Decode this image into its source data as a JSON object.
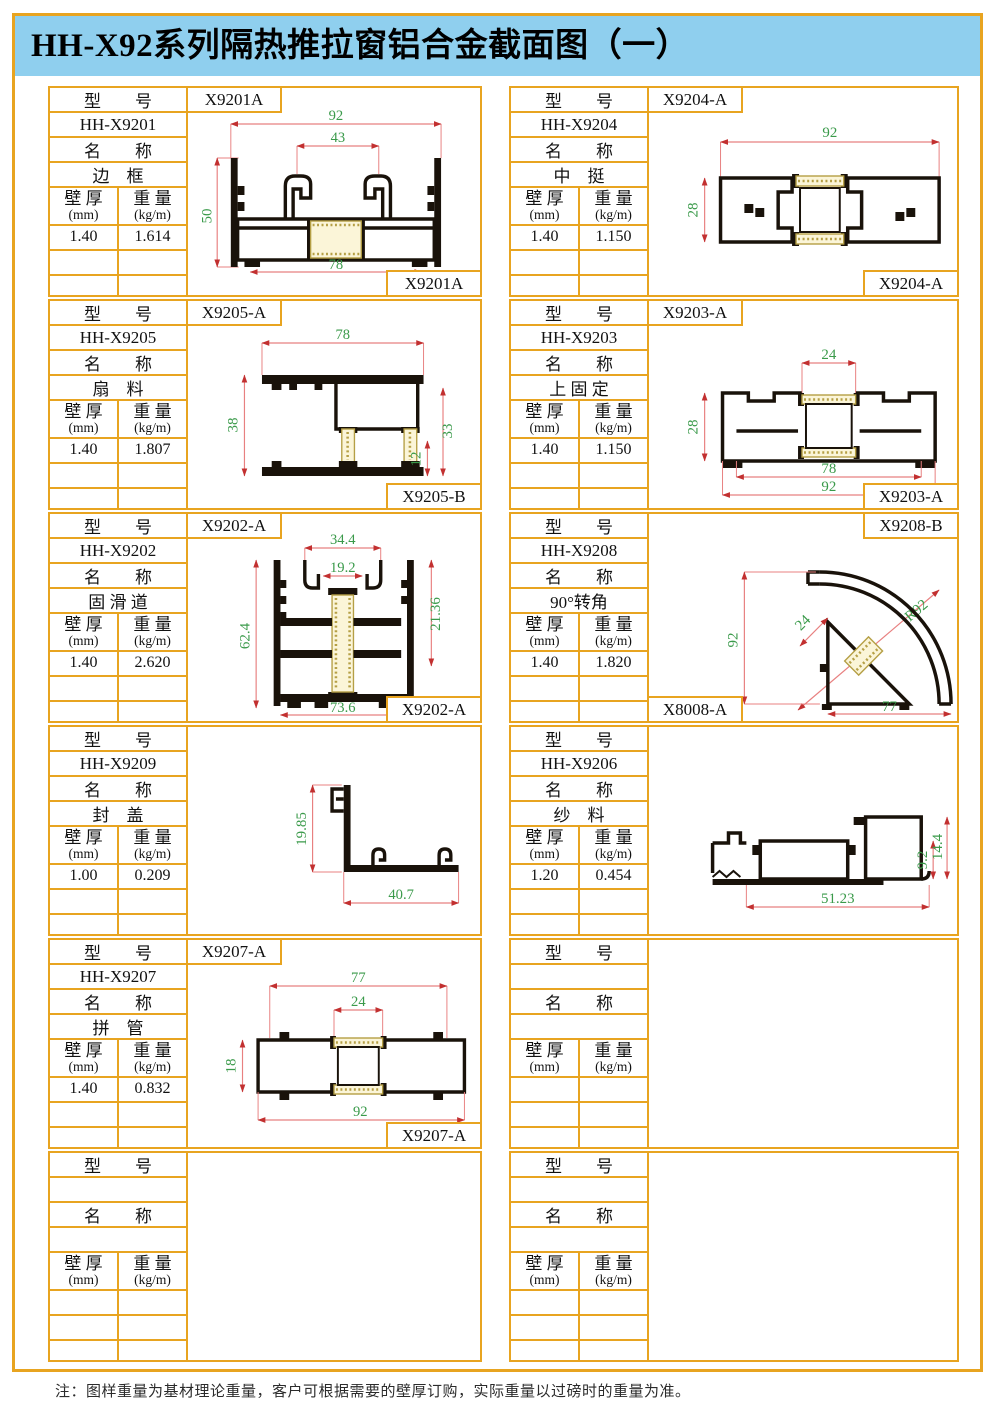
{
  "page": {
    "title": "HH-X92系列隔热推拉窗铝合金截面图（一）",
    "footnote": "注：图样重量为基材理论重量，客户可根据需要的壁厚订购，实际重量以过磅时的重量为准。"
  },
  "labels": {
    "model_header": "型　　号",
    "name_header": "名　　称",
    "thickness_l1": "壁 厚",
    "thickness_l2": "(mm)",
    "weight_l1": "重 量",
    "weight_l2": "(kg/m)"
  },
  "colors": {
    "border": "#E8A420",
    "header_bg": "#8FCFEE",
    "dim_line": "#E88080",
    "dim_arrow": "#C23030",
    "dim_text": "#3A9A4A",
    "profile": "#19120A",
    "thermal_break": "#B59F45"
  },
  "cells": [
    {
      "model": "HH-X9201",
      "name": "边　框",
      "thickness": "1.40",
      "weight": "1.614",
      "tag_top": "X9201A",
      "tag_bottom": "X9201A",
      "dims": [
        "92",
        "43",
        "50",
        "78"
      ]
    },
    {
      "model": "HH-X9204",
      "name": "中　挺",
      "thickness": "1.40",
      "weight": "1.150",
      "tag_top": "X9204-A",
      "tag_bottom": "X9204-A",
      "dims": [
        "92",
        "28"
      ]
    },
    {
      "model": "HH-X9205",
      "name": "扇　料",
      "thickness": "1.40",
      "weight": "1.807",
      "tag_top": "X9205-A",
      "tag_bottom": "X9205-B",
      "dims": [
        "78",
        "38",
        "33",
        "12"
      ]
    },
    {
      "model": "HH-X9203",
      "name": "上 固 定",
      "thickness": "1.40",
      "weight": "1.150",
      "tag_top": "X9203-A",
      "tag_bottom": "X9203-A",
      "dims": [
        "24",
        "28",
        "78",
        "92"
      ]
    },
    {
      "model": "HH-X9202",
      "name": "固 滑 道",
      "thickness": "1.40",
      "weight": "2.620",
      "tag_top": "X9202-A",
      "tag_bottom": "X9202-A",
      "dims": [
        "34.4",
        "19.2",
        "62.4",
        "21.36",
        "73.6"
      ]
    },
    {
      "model": "HH-X9208",
      "name": "90°转角",
      "thickness": "1.40",
      "weight": "1.820",
      "tag_top": "X9208-B",
      "tag_bottom": "X8008-A",
      "dims": [
        "92",
        "24",
        "R92",
        "77"
      ]
    },
    {
      "model": "HH-X9209",
      "name": "封　盖",
      "thickness": "1.00",
      "weight": "0.209",
      "dims": [
        "19.85",
        "40.7"
      ]
    },
    {
      "model": "HH-X9206",
      "name": "纱　料",
      "thickness": "1.20",
      "weight": "0.454",
      "dims": [
        "9.2",
        "14.4",
        "51.23"
      ]
    },
    {
      "model": "HH-X9207",
      "name": "拼　管",
      "thickness": "1.40",
      "weight": "0.832",
      "tag_top": "X9207-A",
      "tag_bottom": "X9207-A",
      "dims": [
        "77",
        "24",
        "18",
        "92"
      ]
    },
    {
      "model": "",
      "name": "",
      "thickness": "",
      "weight": ""
    },
    {
      "model": "",
      "name": "",
      "thickness": "",
      "weight": ""
    },
    {
      "model": "",
      "name": "",
      "thickness": "",
      "weight": ""
    }
  ]
}
